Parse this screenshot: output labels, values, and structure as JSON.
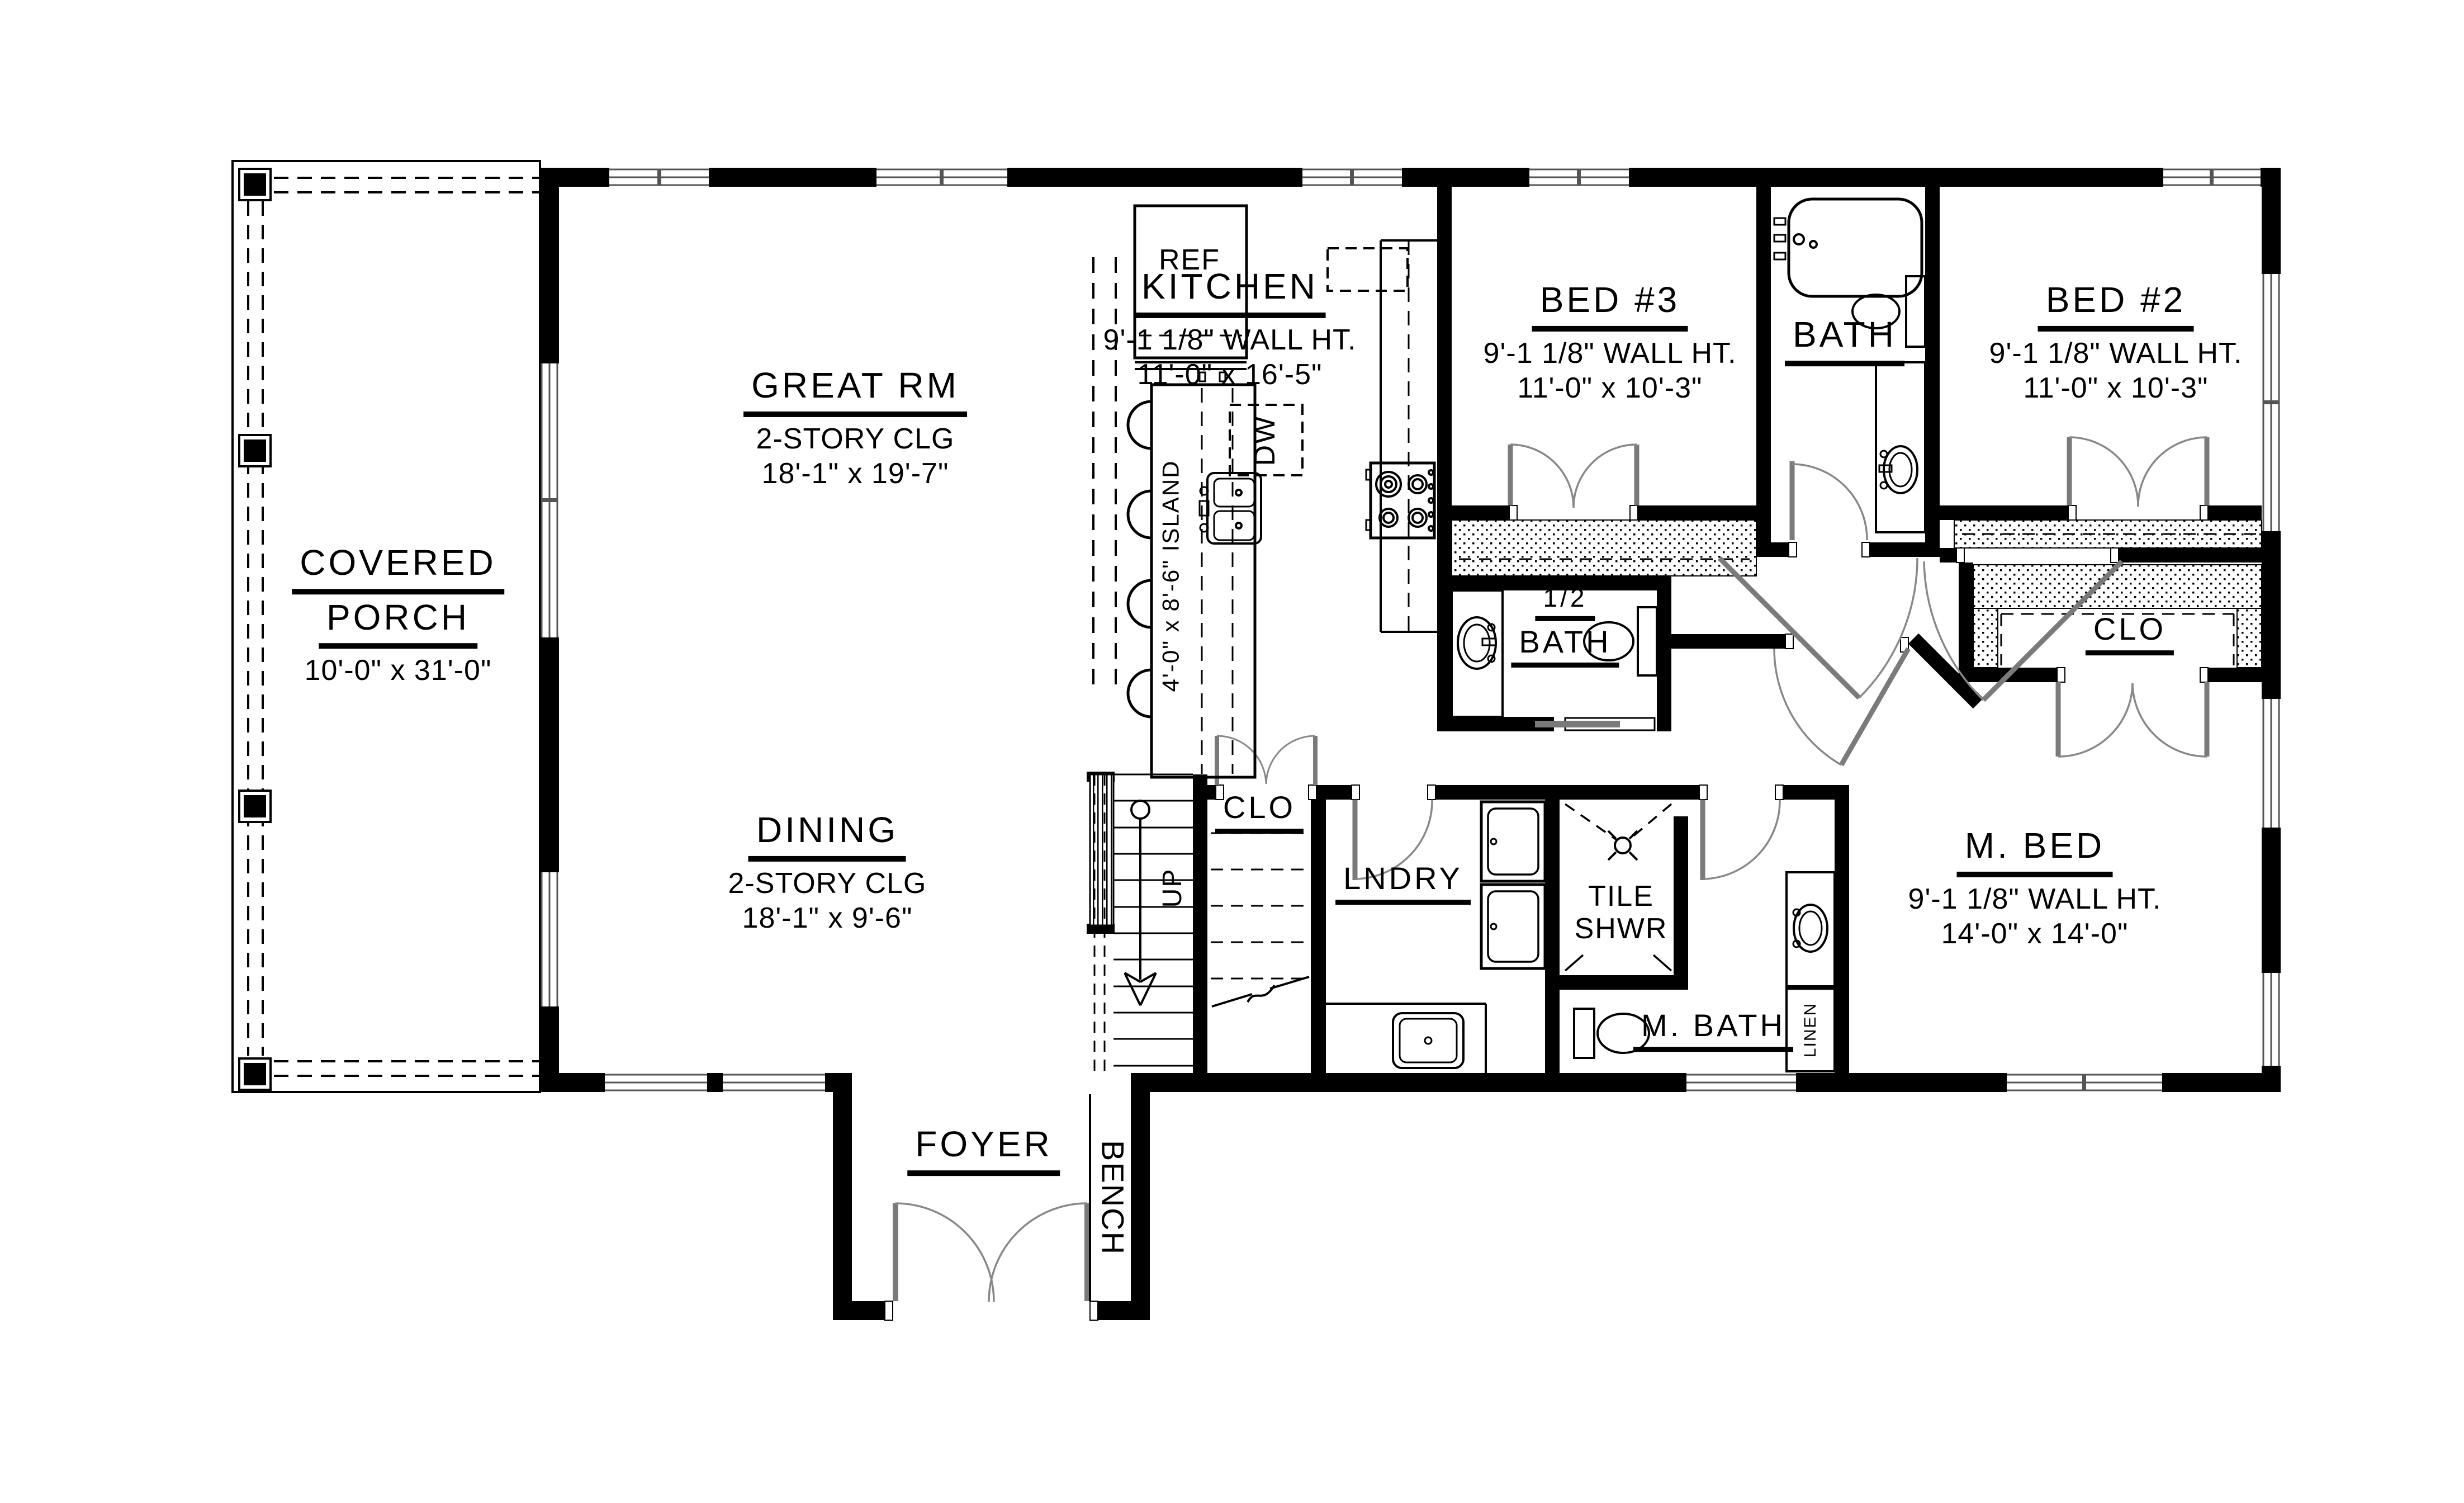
{
  "rooms": {
    "covered_porch": {
      "name_line1": "COVERED",
      "name_line2": "PORCH",
      "dims": "10'-0\" x 31'-0\""
    },
    "great_rm": {
      "name": "GREAT RM",
      "ceiling": "2-STORY CLG",
      "dims": "18'-1\" x 19'-7\""
    },
    "dining": {
      "name": "DINING",
      "ceiling": "2-STORY CLG",
      "dims": "18'-1\" x 9'-6\""
    },
    "kitchen": {
      "name": "KITCHEN",
      "wall_ht": "9'-1 1/8\" WALL HT.",
      "dims": "11'-0\" x 16'-5\""
    },
    "bed3": {
      "name": "BED #3",
      "wall_ht": "9'-1 1/8\" WALL HT.",
      "dims": "11'-0\" x 10'-3\""
    },
    "bed2": {
      "name": "BED #2",
      "wall_ht": "9'-1 1/8\" WALL HT.",
      "dims": "11'-0\" x 10'-3\""
    },
    "bath": {
      "name": "BATH"
    },
    "half_bath": {
      "name_line1": "1/2",
      "name_line2": "BATH"
    },
    "master_bed": {
      "name": "M. BED",
      "wall_ht": "9'-1 1/8\" WALL HT.",
      "dims": "14'-0\" x 14'-0\""
    },
    "master_bath": {
      "name": "M. BATH"
    },
    "master_closet": {
      "name": "CLO"
    },
    "stair_closet": {
      "name": "CLO"
    },
    "laundry": {
      "name": "LNDRY"
    },
    "tile_shower": {
      "line1": "TILE",
      "line2": "SHWR"
    },
    "foyer": {
      "name": "FOYER"
    },
    "bench": {
      "name": "BENCH"
    },
    "linen": {
      "name": "LINEN"
    }
  },
  "fixtures": {
    "ref": "REF",
    "dw": "DW",
    "island": "4'-0\" x 8'-6\" ISLAND",
    "stairs_up": "UP"
  },
  "colors": {
    "wall": "#000000",
    "door": "#7a7a7a",
    "background": "#ffffff",
    "line": "#000000"
  }
}
